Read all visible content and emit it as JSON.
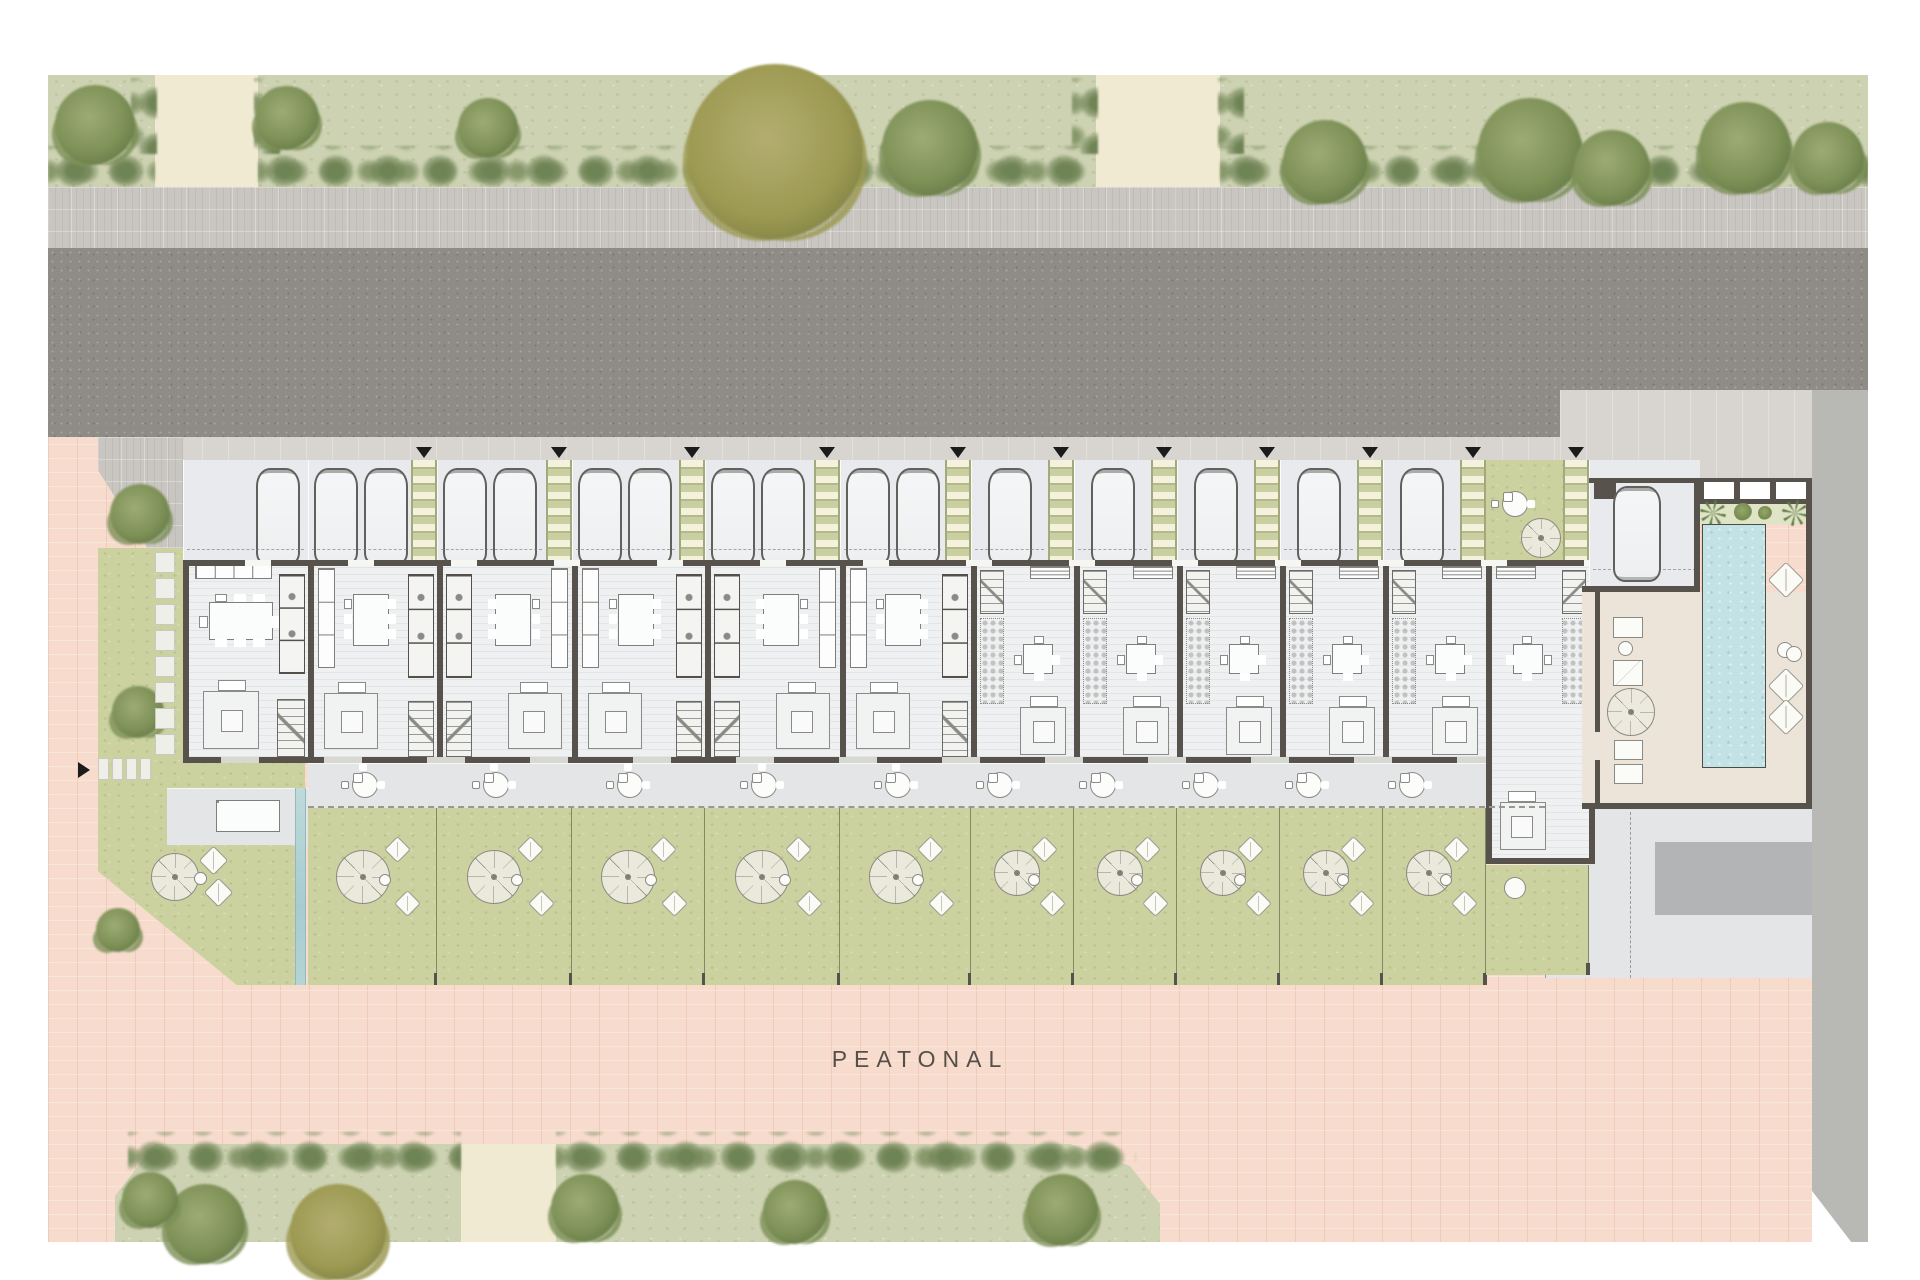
{
  "title": "residential-row-housing-site-plan",
  "labels": {
    "pedestrian_street": "PEATONAL"
  },
  "site": {
    "streets": {
      "top": "vehicular-road",
      "bottom": "pedestrian-promenade"
    },
    "entry_marker_count": 11,
    "units": [
      {
        "id": "01",
        "type": "corner",
        "x": 183,
        "w": 125,
        "cars": 1,
        "ladder": false,
        "mirrored": false
      },
      {
        "id": "02",
        "type": "A",
        "x": 308,
        "w": 129,
        "cars": 2,
        "ladder": true,
        "mirrored": false
      },
      {
        "id": "03",
        "type": "A",
        "x": 437,
        "w": 135,
        "cars": 2,
        "ladder": true,
        "mirrored": true
      },
      {
        "id": "04",
        "type": "A",
        "x": 572,
        "w": 133,
        "cars": 2,
        "ladder": true,
        "mirrored": false
      },
      {
        "id": "05",
        "type": "A",
        "x": 705,
        "w": 135,
        "cars": 2,
        "ladder": true,
        "mirrored": true
      },
      {
        "id": "06",
        "type": "A",
        "x": 840,
        "w": 131,
        "cars": 2,
        "ladder": true,
        "mirrored": false
      },
      {
        "id": "07",
        "type": "B",
        "x": 971,
        "w": 103,
        "cars": 1,
        "ladder": true,
        "mirrored": false
      },
      {
        "id": "08",
        "type": "B",
        "x": 1074,
        "w": 103,
        "cars": 1,
        "ladder": true,
        "mirrored": false
      },
      {
        "id": "09",
        "type": "B",
        "x": 1177,
        "w": 103,
        "cars": 1,
        "ladder": true,
        "mirrored": false
      },
      {
        "id": "10",
        "type": "B",
        "x": 1280,
        "w": 103,
        "cars": 1,
        "ladder": true,
        "mirrored": false
      },
      {
        "id": "11",
        "type": "B",
        "x": 1383,
        "w": 103,
        "cars": 1,
        "ladder": true,
        "mirrored": false
      },
      {
        "id": "12",
        "type": "B",
        "x": 1486,
        "w": 103,
        "cars": 0,
        "ladder": true,
        "mirrored": true,
        "communal_garden_parking": true,
        "deep_interior": true,
        "small_garden": true
      }
    ],
    "amenities": [
      "communal-pool",
      "pool-deck",
      "sun-loungers",
      "parasols",
      "private-gardens",
      "guest-parking"
    ],
    "landscape": {
      "top_trees": [
        {
          "x": 95,
          "y": 125,
          "r": 40
        },
        {
          "x": 287,
          "y": 118,
          "r": 32
        },
        {
          "x": 488,
          "y": 128,
          "r": 30
        },
        {
          "x": 775,
          "y": 152,
          "r": 88,
          "olive": true
        },
        {
          "x": 930,
          "y": 148,
          "r": 48
        },
        {
          "x": 1325,
          "y": 162,
          "r": 42
        },
        {
          "x": 1530,
          "y": 150,
          "r": 52
        },
        {
          "x": 1612,
          "y": 168,
          "r": 38
        },
        {
          "x": 1745,
          "y": 148,
          "r": 46
        },
        {
          "x": 1828,
          "y": 158,
          "r": 36
        }
      ],
      "bottom_trees": [
        {
          "x": 205,
          "y": 1224,
          "r": 40
        },
        {
          "x": 338,
          "y": 1232,
          "r": 48,
          "olive": true
        },
        {
          "x": 585,
          "y": 1208,
          "r": 34
        },
        {
          "x": 795,
          "y": 1212,
          "r": 32
        },
        {
          "x": 1062,
          "y": 1210,
          "r": 36
        },
        {
          "x": 150,
          "y": 1200,
          "r": 28
        }
      ],
      "corner_trees": [
        {
          "x": 140,
          "y": 514,
          "r": 30
        },
        {
          "x": 138,
          "y": 712,
          "r": 26
        },
        {
          "x": 118,
          "y": 930,
          "r": 22
        }
      ]
    }
  },
  "colors": {
    "road": "#8f8b86",
    "sidewalk": "#c9c6c2",
    "pedestrian_paving": "#f7dccd",
    "lawn": "#cbd2a0",
    "band_lawn": "#cdd2b2",
    "walls": "#57524b",
    "pool_water": "#c2e2e6",
    "deck": "#ece4d8",
    "walkway": "#c9cfa0",
    "interior": "#eef0f1",
    "plaza": "#e3e5e7",
    "accent_marker": "#1b1b1b"
  }
}
